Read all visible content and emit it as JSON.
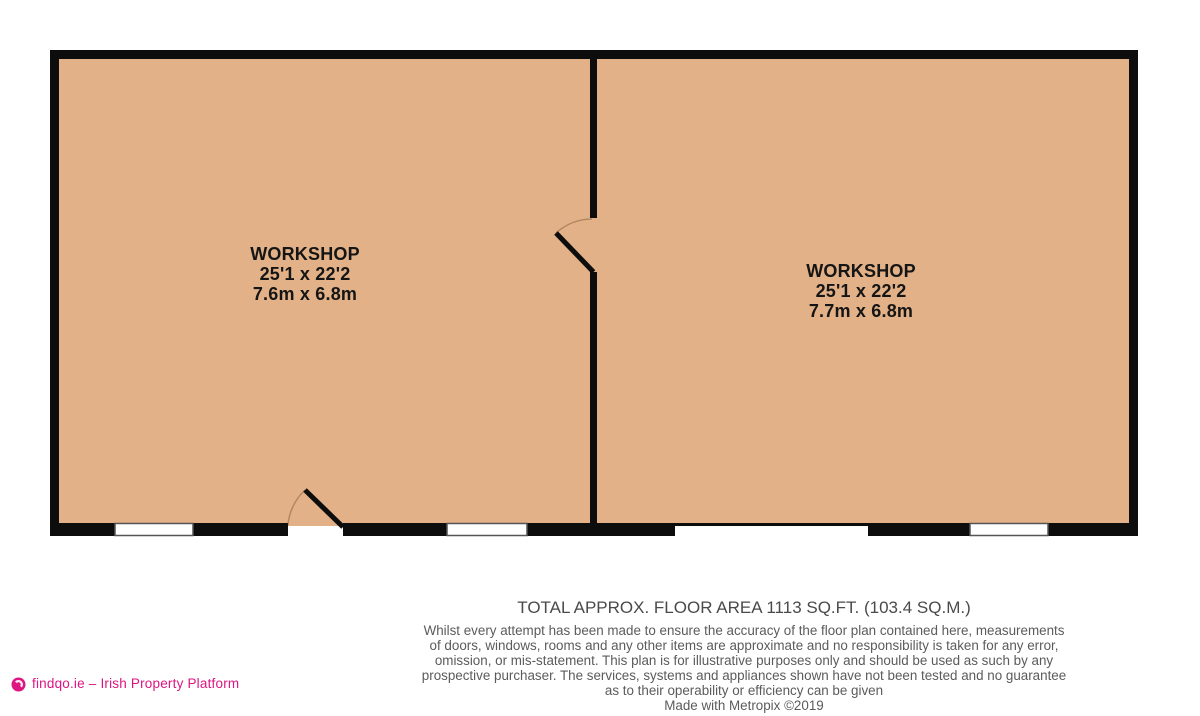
{
  "rooms": [
    {
      "name": "WORKSHOP",
      "dims_imperial": "25'1 x 22'2",
      "dims_metric": "7.6m x 6.8m"
    },
    {
      "name": "WORKSHOP",
      "dims_imperial": "25'1 x 22'2",
      "dims_metric": "7.7m x 6.8m"
    }
  ],
  "footer": {
    "total_area": "TOTAL APPROX. FLOOR AREA 1113 SQ.FT. (103.4 SQ.M.)",
    "disclaimer_lines": [
      "Whilst every attempt has been made to ensure the accuracy of the floor plan contained here, measurements",
      "of doors, windows, rooms and any other items are approximate and no responsibility is taken for any error,",
      "omission, or mis-statement. This plan is for illustrative purposes only and should be used as such by any",
      "prospective purchaser. The services, systems and appliances shown have not been tested and no guarantee",
      "as to their operability or efficiency can be given"
    ],
    "made_with": "Made with Metropix ©2019"
  },
  "branding": {
    "logo_text": "findqo.ie – Irish Property Platform",
    "brand_color": "#de1480"
  },
  "colors": {
    "room_fill": "#e2b187",
    "wall": "#0d0d0d",
    "window_fill": "#ffffff",
    "footer_text": "#5b5b5b"
  }
}
